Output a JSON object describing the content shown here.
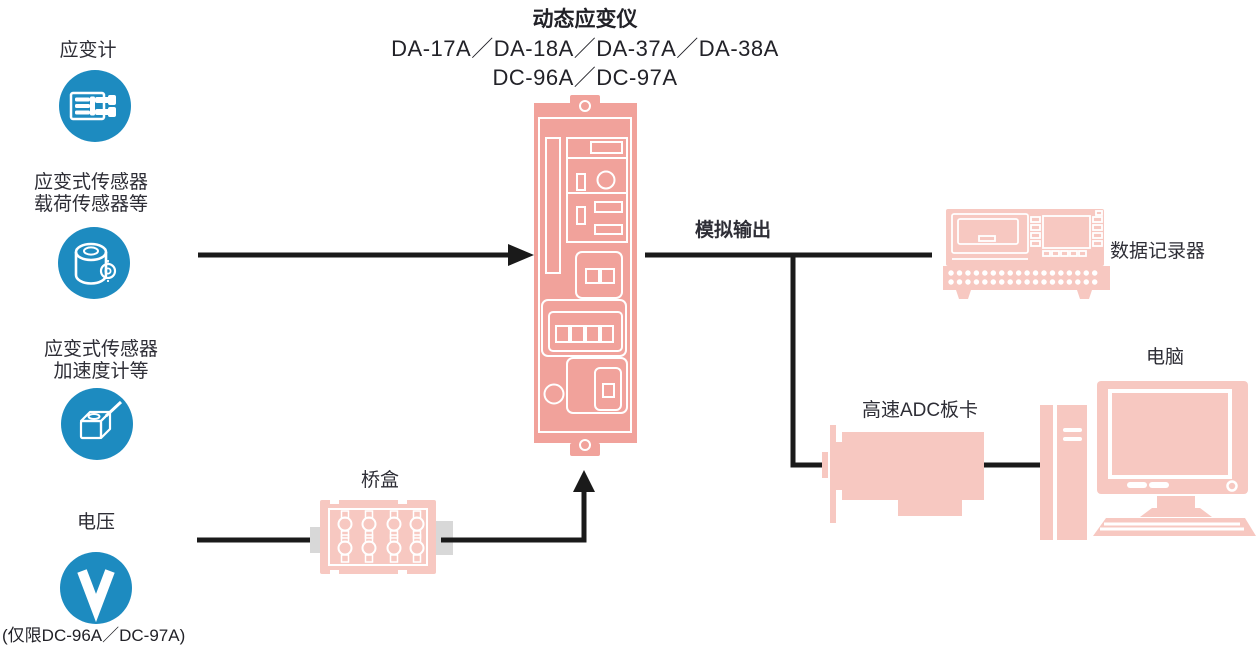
{
  "amplifier": {
    "title": "动态应变仪",
    "models_line1": "DA-17A／DA-18A／DA-37A／DA-38A",
    "models_line2": "DC-96A／DC-97A"
  },
  "sources": {
    "strain_gauge": {
      "label": "应变计"
    },
    "load_sensor": {
      "label1": "应变式传感器",
      "label2": "载荷传感器等"
    },
    "accelerometer": {
      "label1": "应变式传感器",
      "label2": "加速度计等"
    },
    "voltage": {
      "label": "电压",
      "note": "(仅限DC-96A／DC-97A)"
    }
  },
  "bridge_box": {
    "label": "桥盒"
  },
  "outputs": {
    "analog_label": "模拟输出",
    "data_recorder_label": "数据记录器",
    "adc_label": "高速ADC板卡",
    "computer_label": "电脑"
  },
  "icons": {
    "strain_gauge": "strain-gauge-icon",
    "load_cell": "load-cell-icon",
    "accelerometer": "accelerometer-icon",
    "voltage": "voltage-icon",
    "amplifier": "amplifier-module",
    "bridge_box": "bridge-box",
    "data_recorder": "data-recorder",
    "adc_board": "adc-board",
    "computer": "desktop-computer"
  },
  "colors": {
    "sensor_blue": "#1d8bc0",
    "amplifier_salmon": "#f1a29b",
    "device_pink": "#f7c8c1",
    "tab_gray": "#d8d8d8",
    "line_black": "#1a1a1a",
    "text": "#2e2e36"
  }
}
